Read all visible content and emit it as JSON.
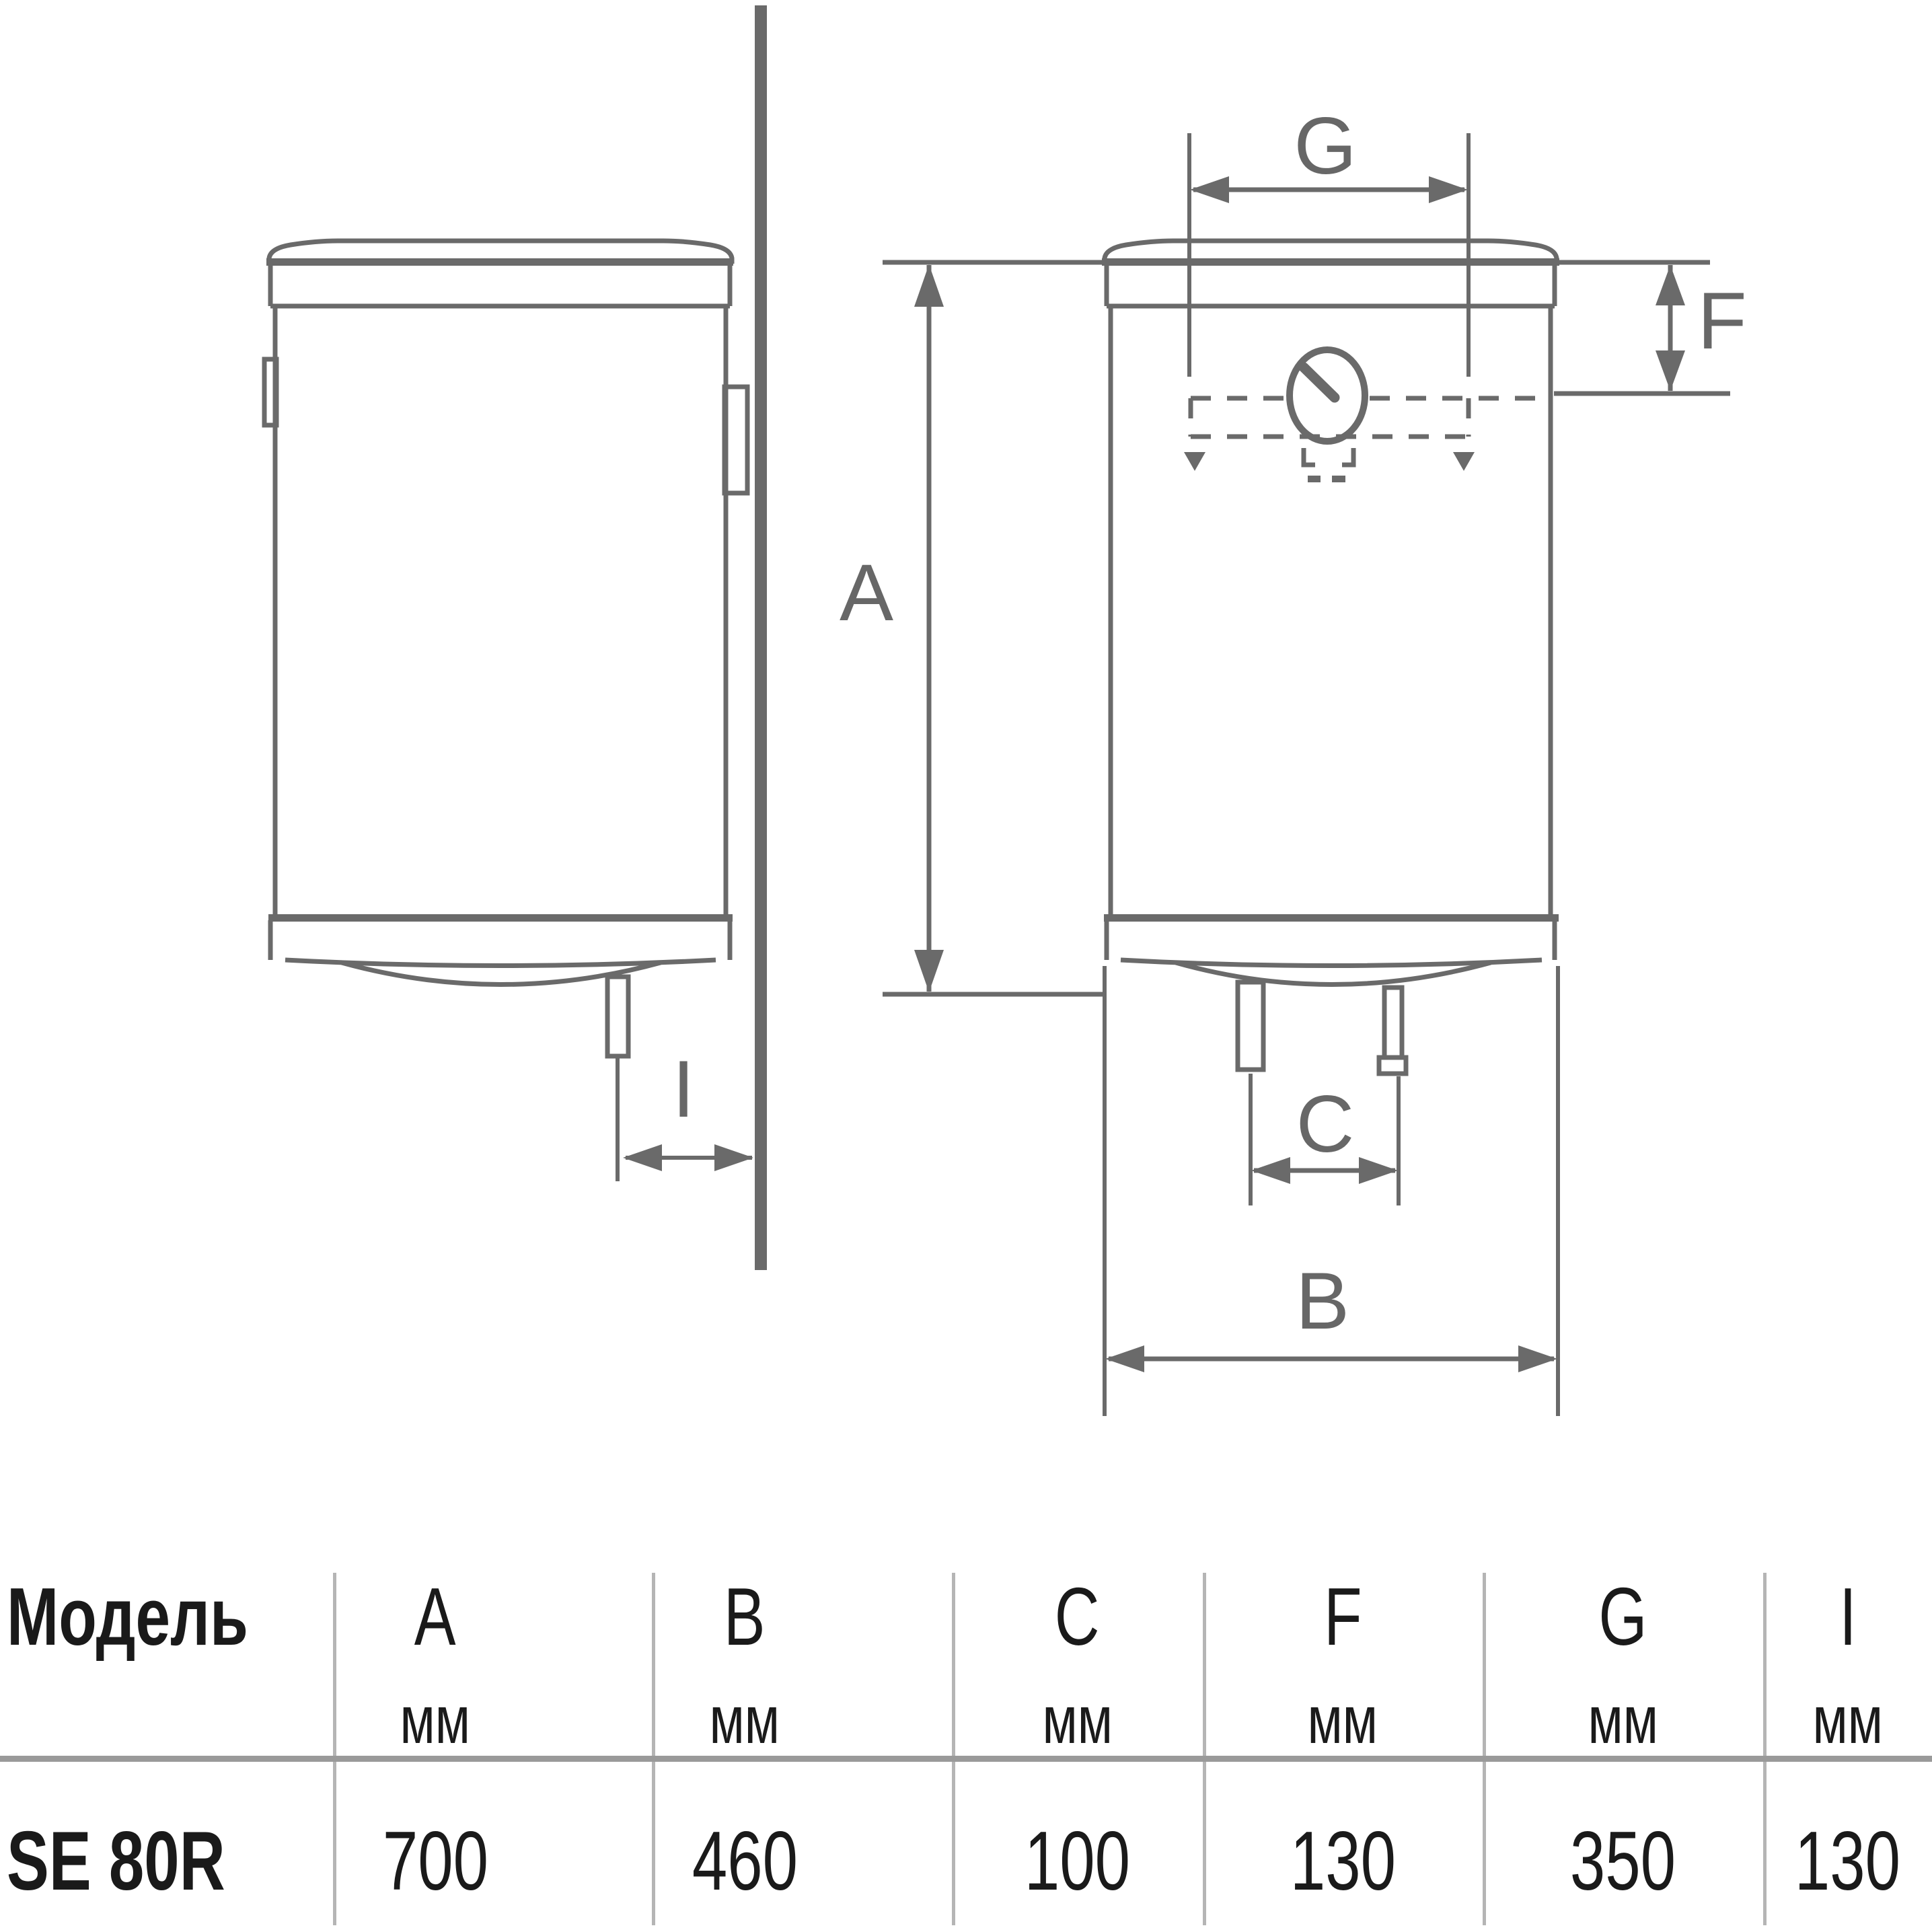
{
  "diagram": {
    "labels": {
      "a": "A",
      "b": "B",
      "c": "C",
      "f": "F",
      "g": "G",
      "i": "I"
    }
  },
  "table": {
    "header": {
      "model": "Модель",
      "unit": "мм",
      "dims": [
        "A",
        "B",
        "C",
        "F",
        "G",
        "I"
      ]
    },
    "row": {
      "model": "SE 80R",
      "values": [
        "700",
        "460",
        "100",
        "130",
        "350",
        "130"
      ]
    }
  },
  "colors": {
    "line": "#6a6a6a",
    "text": "#1a1a1a",
    "divider": "#b5b5b5",
    "rule": "#9a9a9a"
  }
}
